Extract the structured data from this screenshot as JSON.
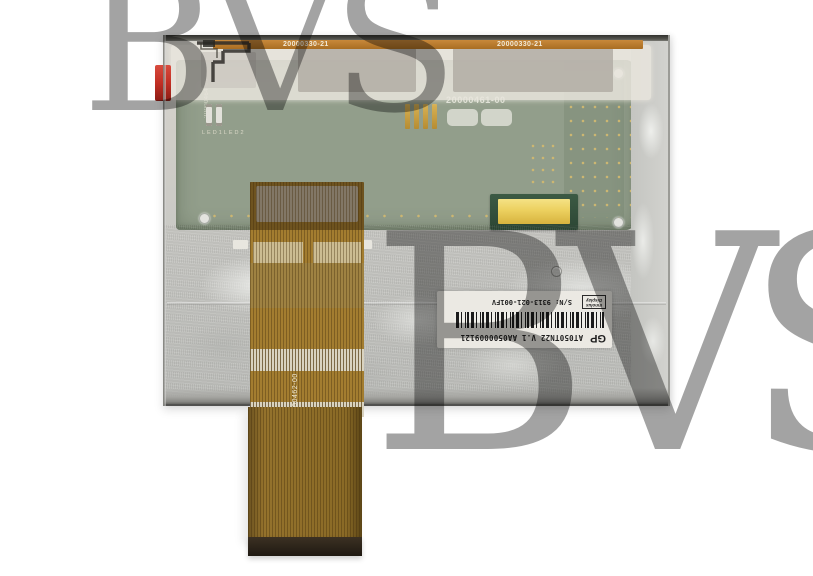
{
  "photo": {
    "subject": "LCD display module back side with flex ribbon cable",
    "watermark_text": "BVS"
  },
  "module": {
    "top_strip": {
      "label_left": "20000330-21",
      "label_right": "20000330-21"
    },
    "pcb": {
      "part_number_silk": "20000461-00",
      "side_part_number": "20000464-00",
      "led_silk_1": "LED1",
      "led_silk_2": "LED2"
    },
    "flex_cable": {
      "part_number": "20000462-00"
    },
    "label": {
      "vendor_mark": "GP",
      "model_line": "AT050TN22 V.1 AA0500009121",
      "serial_number": "S/N: 9313-021-001FV",
      "brand_line1": "Innolux",
      "brand_line2": "Display"
    }
  },
  "colors": {
    "pcb_green": "#929e8b",
    "frame_gray": "#c8c8c4",
    "flex_amber": "#a37d30",
    "flex_dark": "#6e531f",
    "gold_pad": "#ecd05f",
    "pull_tab_red": "#c12f24",
    "top_strip_amber": "#b4782a",
    "label_bg": "#ebe9e3",
    "watermark_gray": "#9a9a9a"
  }
}
